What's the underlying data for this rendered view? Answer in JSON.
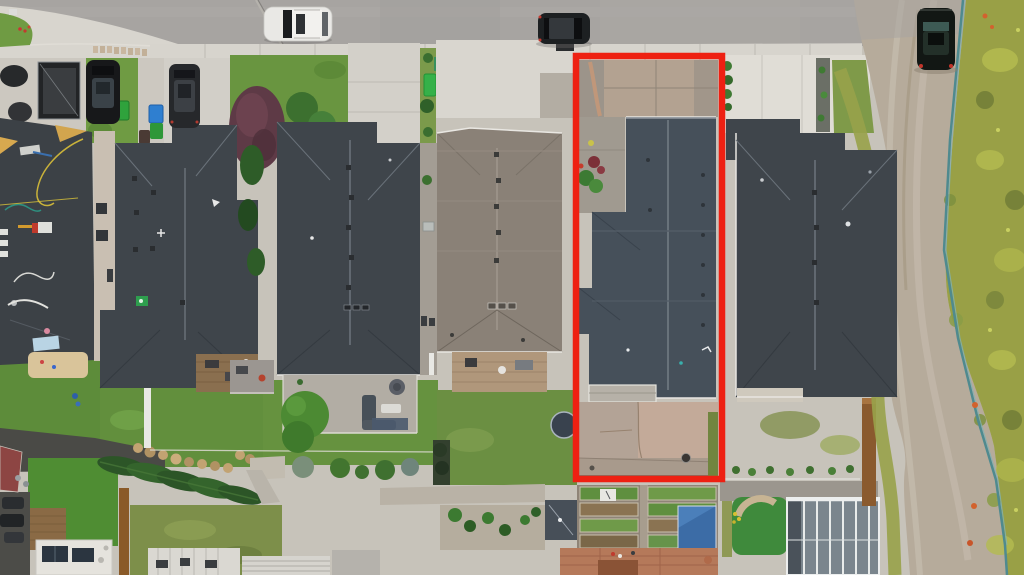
{
  "scene": {
    "description": "Aerial drone photo of a row of suburban houses with dark shingle roofs; one narrow lot is outlined with a red highlight rectangle; street with parked cars at top, backyards and garden plots at bottom, gravel lane and weedy meadow on the right",
    "highlight": {
      "label": "highlighted-property-lot",
      "color": "#EE2012"
    }
  },
  "palette": {
    "asphalt": "#A7A4A1",
    "asphalt_wear": "#B4B1AD",
    "sidewalk": "#D7D4CD",
    "concrete": "#CFCCC5",
    "concrete_bright": "#E0DDD6",
    "driveway_stained": "#B3A291",
    "walk_gray": "#A39D93",
    "patio_pink": "#C2AA99",
    "gravel": "#B6AB9B",
    "roof_charcoal": "#3F454B",
    "roof_slate": "#46505A",
    "roof_taupe": "#8A8177",
    "fascia": "#E8E6E1",
    "lawn": "#6F9B43",
    "lawn_deep": "#5D8C3A",
    "lawn_olive": "#8A9A4E",
    "meadow": "#99A046",
    "turf": "#4F8D33",
    "putting_green": "#3F8A3C",
    "tree_green": "#2F5F28",
    "tree_purple": "#5E3A46",
    "bin_green": "#2FA23C",
    "bin_blue": "#2F7FD0",
    "tarp_blue": "#3C6CA6",
    "terracotta": "#B5795A",
    "wood": "#8A6A45",
    "fence_brown": "#8A5A2E",
    "sand": "#D9C49A",
    "soil": "#8A7352",
    "glass": "#7A858D",
    "utility_teal": "#4F8A8F",
    "marker_orange": "#D2622E",
    "car_white": "#E9E8E5",
    "car_black": "#17181A",
    "osb_tan": "#C9A24E"
  },
  "inventory": {
    "vehicles": [
      {
        "name": "white-suv-parked-on-street"
      },
      {
        "name": "dark-sedan-parked-on-street"
      },
      {
        "name": "dark-suv-on-gravel-lane"
      },
      {
        "name": "black-suv-on-driveway"
      },
      {
        "name": "dark-car-on-driveway"
      },
      {
        "name": "utility-trailer-with-tarp"
      }
    ],
    "bins": [
      "green",
      "blue",
      "blue",
      "green",
      "green"
    ],
    "features": [
      "streetlight",
      "construction-roof-with-osb-patches",
      "purple-leaf-tree",
      "conifer-row",
      "rock-retaining-wall",
      "garden-beds",
      "blue-tarp-shed",
      "greenhouse",
      "putting-green",
      "trampoline",
      "utility-line",
      "orange-survey-markers"
    ]
  }
}
